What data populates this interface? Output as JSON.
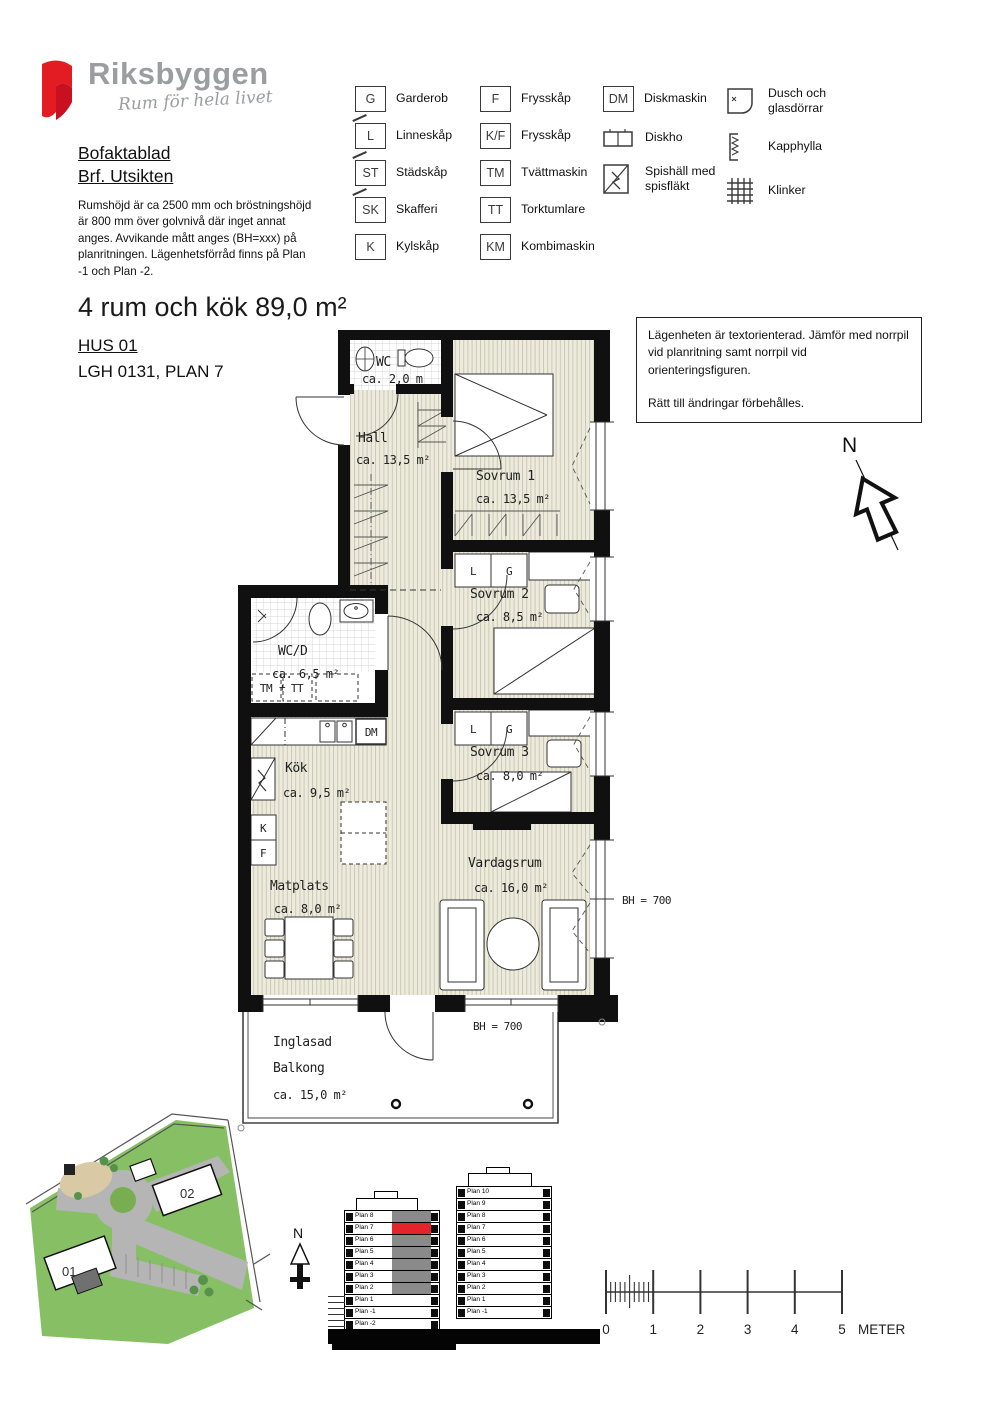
{
  "logo": {
    "brand": "Riksbyggen",
    "tagline": "Rum för hela livet"
  },
  "header": {
    "title1": "Bofaktablad",
    "title2": "Brf. Utsikten",
    "description": "Rumshöjd är ca 2500 mm och bröstningshöjd är 800 mm över golvnivå där inget annat anges. Avvikande mått anges (BH=xxx) på planritningen. Lägenhetsförråd finns på Plan -1 och Plan -2."
  },
  "legend": {
    "col1": [
      {
        "symbol": "G",
        "label": "Garderob"
      },
      {
        "symbol": "L",
        "label": "Linneskåp"
      },
      {
        "symbol": "ST",
        "label": "Städskåp"
      },
      {
        "symbol": "SK",
        "label": "Skafferi"
      },
      {
        "symbol": "K",
        "label": "Kylskåp"
      }
    ],
    "col2": [
      {
        "symbol": "F",
        "label": "Frysskåp"
      },
      {
        "symbol": "K/F",
        "label": "Frysskåp"
      },
      {
        "symbol": "TM",
        "label": "Tvättmaskin"
      },
      {
        "symbol": "TT",
        "label": "Torktumlare"
      },
      {
        "symbol": "KM",
        "label": "Kombimaskin"
      }
    ],
    "col3": [
      {
        "symbol": "DM",
        "label": "Diskmaskin"
      },
      {
        "label": "Diskho"
      },
      {
        "label": "Spishäll med",
        "label2": "spisfläkt"
      }
    ],
    "col4": [
      {
        "label": "Dusch och",
        "label2": "glasdörrar"
      },
      {
        "label": "Kapphylla"
      },
      {
        "label": "Klinker"
      }
    ]
  },
  "apartment": {
    "title": "4 rum och kök  89,0 m²",
    "hus": "HUS 01",
    "lgh": "LGH 0131, PLAN 7"
  },
  "notice": {
    "para1": "Lägenheten är textorienterad. Jämför med norrpil vid planritning samt norrpil vid orienteringsfiguren.",
    "para2": "Rätt till ändringar förbehålles."
  },
  "floorplan": {
    "rooms": {
      "wc": {
        "name": "WC",
        "area": "ca. 2,0 m"
      },
      "hall": {
        "name": "Hall",
        "area": "ca. 13,5 m²"
      },
      "sovrum1": {
        "name": "Sovrum 1",
        "area": "ca. 13,5 m²"
      },
      "sovrum2": {
        "name": "Sovrum 2",
        "area": "ca. 8,5 m²"
      },
      "sovrum3": {
        "name": "Sovrum 3",
        "area": "ca. 8,0 m²"
      },
      "wcd": {
        "name": "WC/D",
        "area": "ca. 6,5 m²"
      },
      "kok": {
        "name": "Kök",
        "area": "ca. 9,5 m²"
      },
      "matplats": {
        "name": "Matplats",
        "area": "ca. 8,0 m²"
      },
      "vardagsrum": {
        "name": "Vardagsrum",
        "area": "ca. 16,0 m²"
      },
      "balkong": {
        "name1": "Inglasad",
        "name2": "Balkong",
        "area": "ca. 15,0 m²"
      }
    },
    "labels": {
      "bh1": "BH = 700",
      "bh2": "BH = 700",
      "tm": "TM",
      "tt": "TT",
      "plus": "+",
      "dm": "DM",
      "k": "K",
      "f": "F",
      "l": "L",
      "g": "G"
    },
    "north": "N"
  },
  "site": {
    "b01": "01",
    "b02": "02",
    "north": "N"
  },
  "elevations": {
    "left": {
      "floors": [
        {
          "label": "Plan 8",
          "fill": "gray"
        },
        {
          "label": "Plan 7",
          "fill": "red"
        },
        {
          "label": "Plan 6",
          "fill": "gray"
        },
        {
          "label": "Plan 5",
          "fill": "gray"
        },
        {
          "label": "Plan 4",
          "fill": "gray"
        },
        {
          "label": "Plan 3",
          "fill": "gray"
        },
        {
          "label": "Plan 2",
          "fill": "gray"
        },
        {
          "label": "Plan 1",
          "fill": "white"
        },
        {
          "label": "Plan -1",
          "fill": "white"
        },
        {
          "label": "Plan -2",
          "fill": "white"
        }
      ]
    },
    "right": {
      "floors": [
        {
          "label": "Plan 10",
          "fill": "white"
        },
        {
          "label": "Plan 9",
          "fill": "white"
        },
        {
          "label": "Plan 8",
          "fill": "white"
        },
        {
          "label": "Plan 7",
          "fill": "white"
        },
        {
          "label": "Plan 6",
          "fill": "white"
        },
        {
          "label": "Plan 5",
          "fill": "white"
        },
        {
          "label": "Plan 4",
          "fill": "white"
        },
        {
          "label": "Plan 3",
          "fill": "white"
        },
        {
          "label": "Plan 2",
          "fill": "white"
        },
        {
          "label": "Plan 1",
          "fill": "white"
        },
        {
          "label": "Plan -1",
          "fill": "white"
        }
      ]
    }
  },
  "scale_bar": {
    "ticks": [
      "0",
      "1",
      "2",
      "3",
      "4",
      "5"
    ],
    "unit": "METER"
  }
}
